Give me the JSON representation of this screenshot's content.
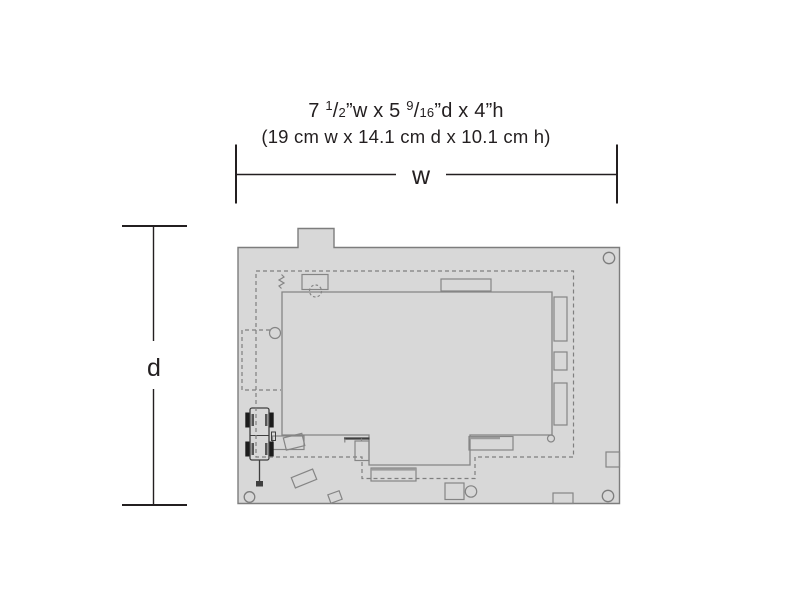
{
  "title": {
    "imperial": {
      "prefix": "7 ",
      "frac1_num": "1",
      "frac1_slash": "/",
      "frac1_den": "2",
      "mid": "”w x 5 ",
      "frac2_num": "9",
      "frac2_slash": "/",
      "frac2_den": "16",
      "suffix": "”d x 4”h"
    },
    "metric": "(19 cm w x 14.1 cm d x 10.1 cm h)"
  },
  "dimension_labels": {
    "width": "w",
    "depth": "d"
  },
  "colors": {
    "background": "#ffffff",
    "base-fill": "#d8d8d8",
    "outline": "#7d7d7d",
    "building-stroke": "#858585",
    "dashed": "#7f7f7f",
    "dark-detail": "#3f3f3f",
    "wheel": "#1c1c1c",
    "text": "#231f20"
  }
}
